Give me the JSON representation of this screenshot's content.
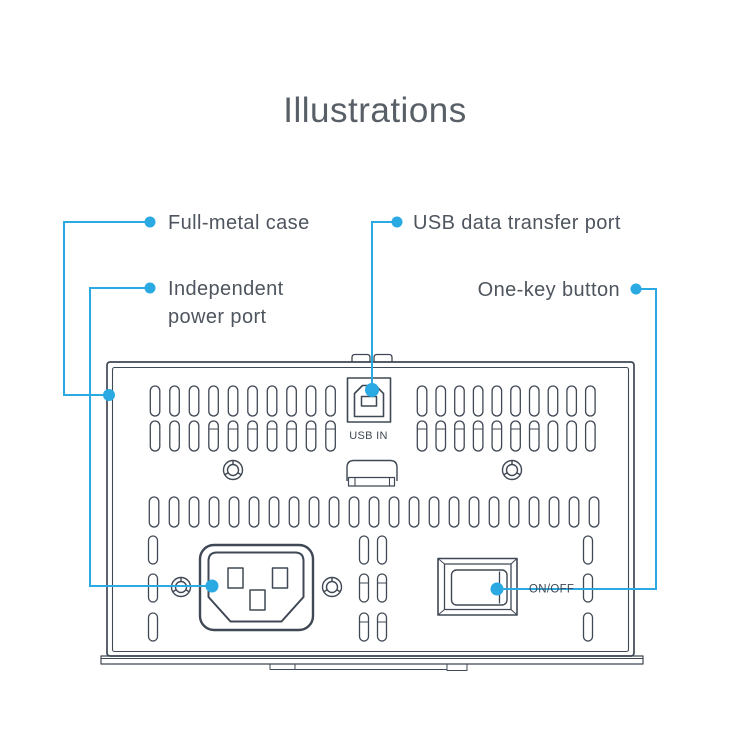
{
  "title": "Illustrations",
  "callouts": {
    "full_metal": "Full-metal case",
    "independent_line1": "Independent",
    "independent_line2": "power port",
    "usb": "USB data transfer port",
    "one_key": "One-key button"
  },
  "panel": {
    "usb_in": "USB IN",
    "on_off": "ON/OFF"
  },
  "colors": {
    "accent_blue": "#2aa9e2",
    "outline_gray": "#3f4854",
    "label_text": "#4e555e",
    "title_text": "#585f67"
  }
}
